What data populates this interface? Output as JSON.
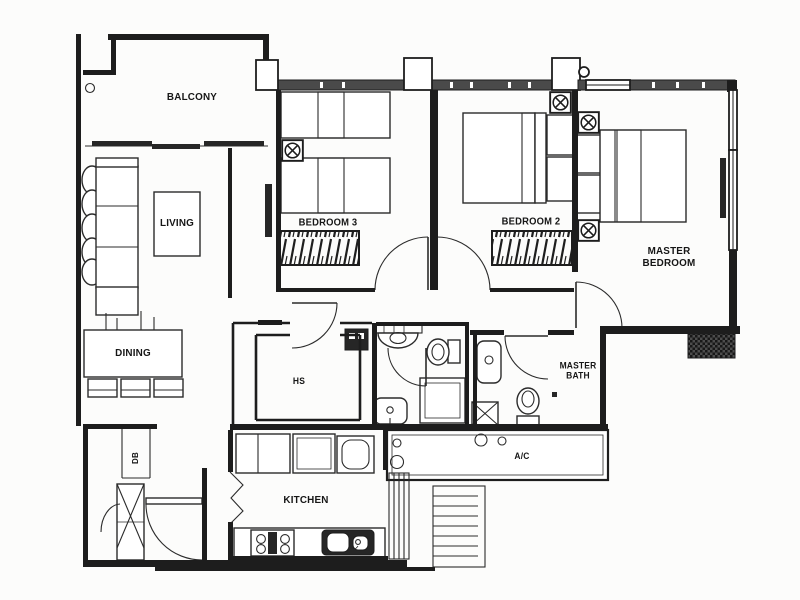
{
  "plan": {
    "rooms": {
      "balcony": "BALCONY",
      "living": "LIVING",
      "dining": "DINING",
      "bedroom3": "BEDROOM 3",
      "bedroom2": "BEDROOM 2",
      "master_bedroom": "MASTER BEDROOM",
      "household_shelter": "HS",
      "master_bath": "MASTER BATH",
      "kitchen": "KITCHEN",
      "ac_ledge": "A/C",
      "db": "DB"
    },
    "symbols": {
      "aircon_fancoil": "circle with X inside a square",
      "door_swing": "quarter-circle arc",
      "wardrobe": "hatched rectangle",
      "window": "double parallel lines",
      "shower": "double-border square",
      "floor_trap": "square with X"
    },
    "colors": {
      "paper": "#fcfcfb",
      "wall": "#1d1d1d",
      "wall_band": "#4a4a4a",
      "furniture_line": "#2b2b2b"
    }
  }
}
